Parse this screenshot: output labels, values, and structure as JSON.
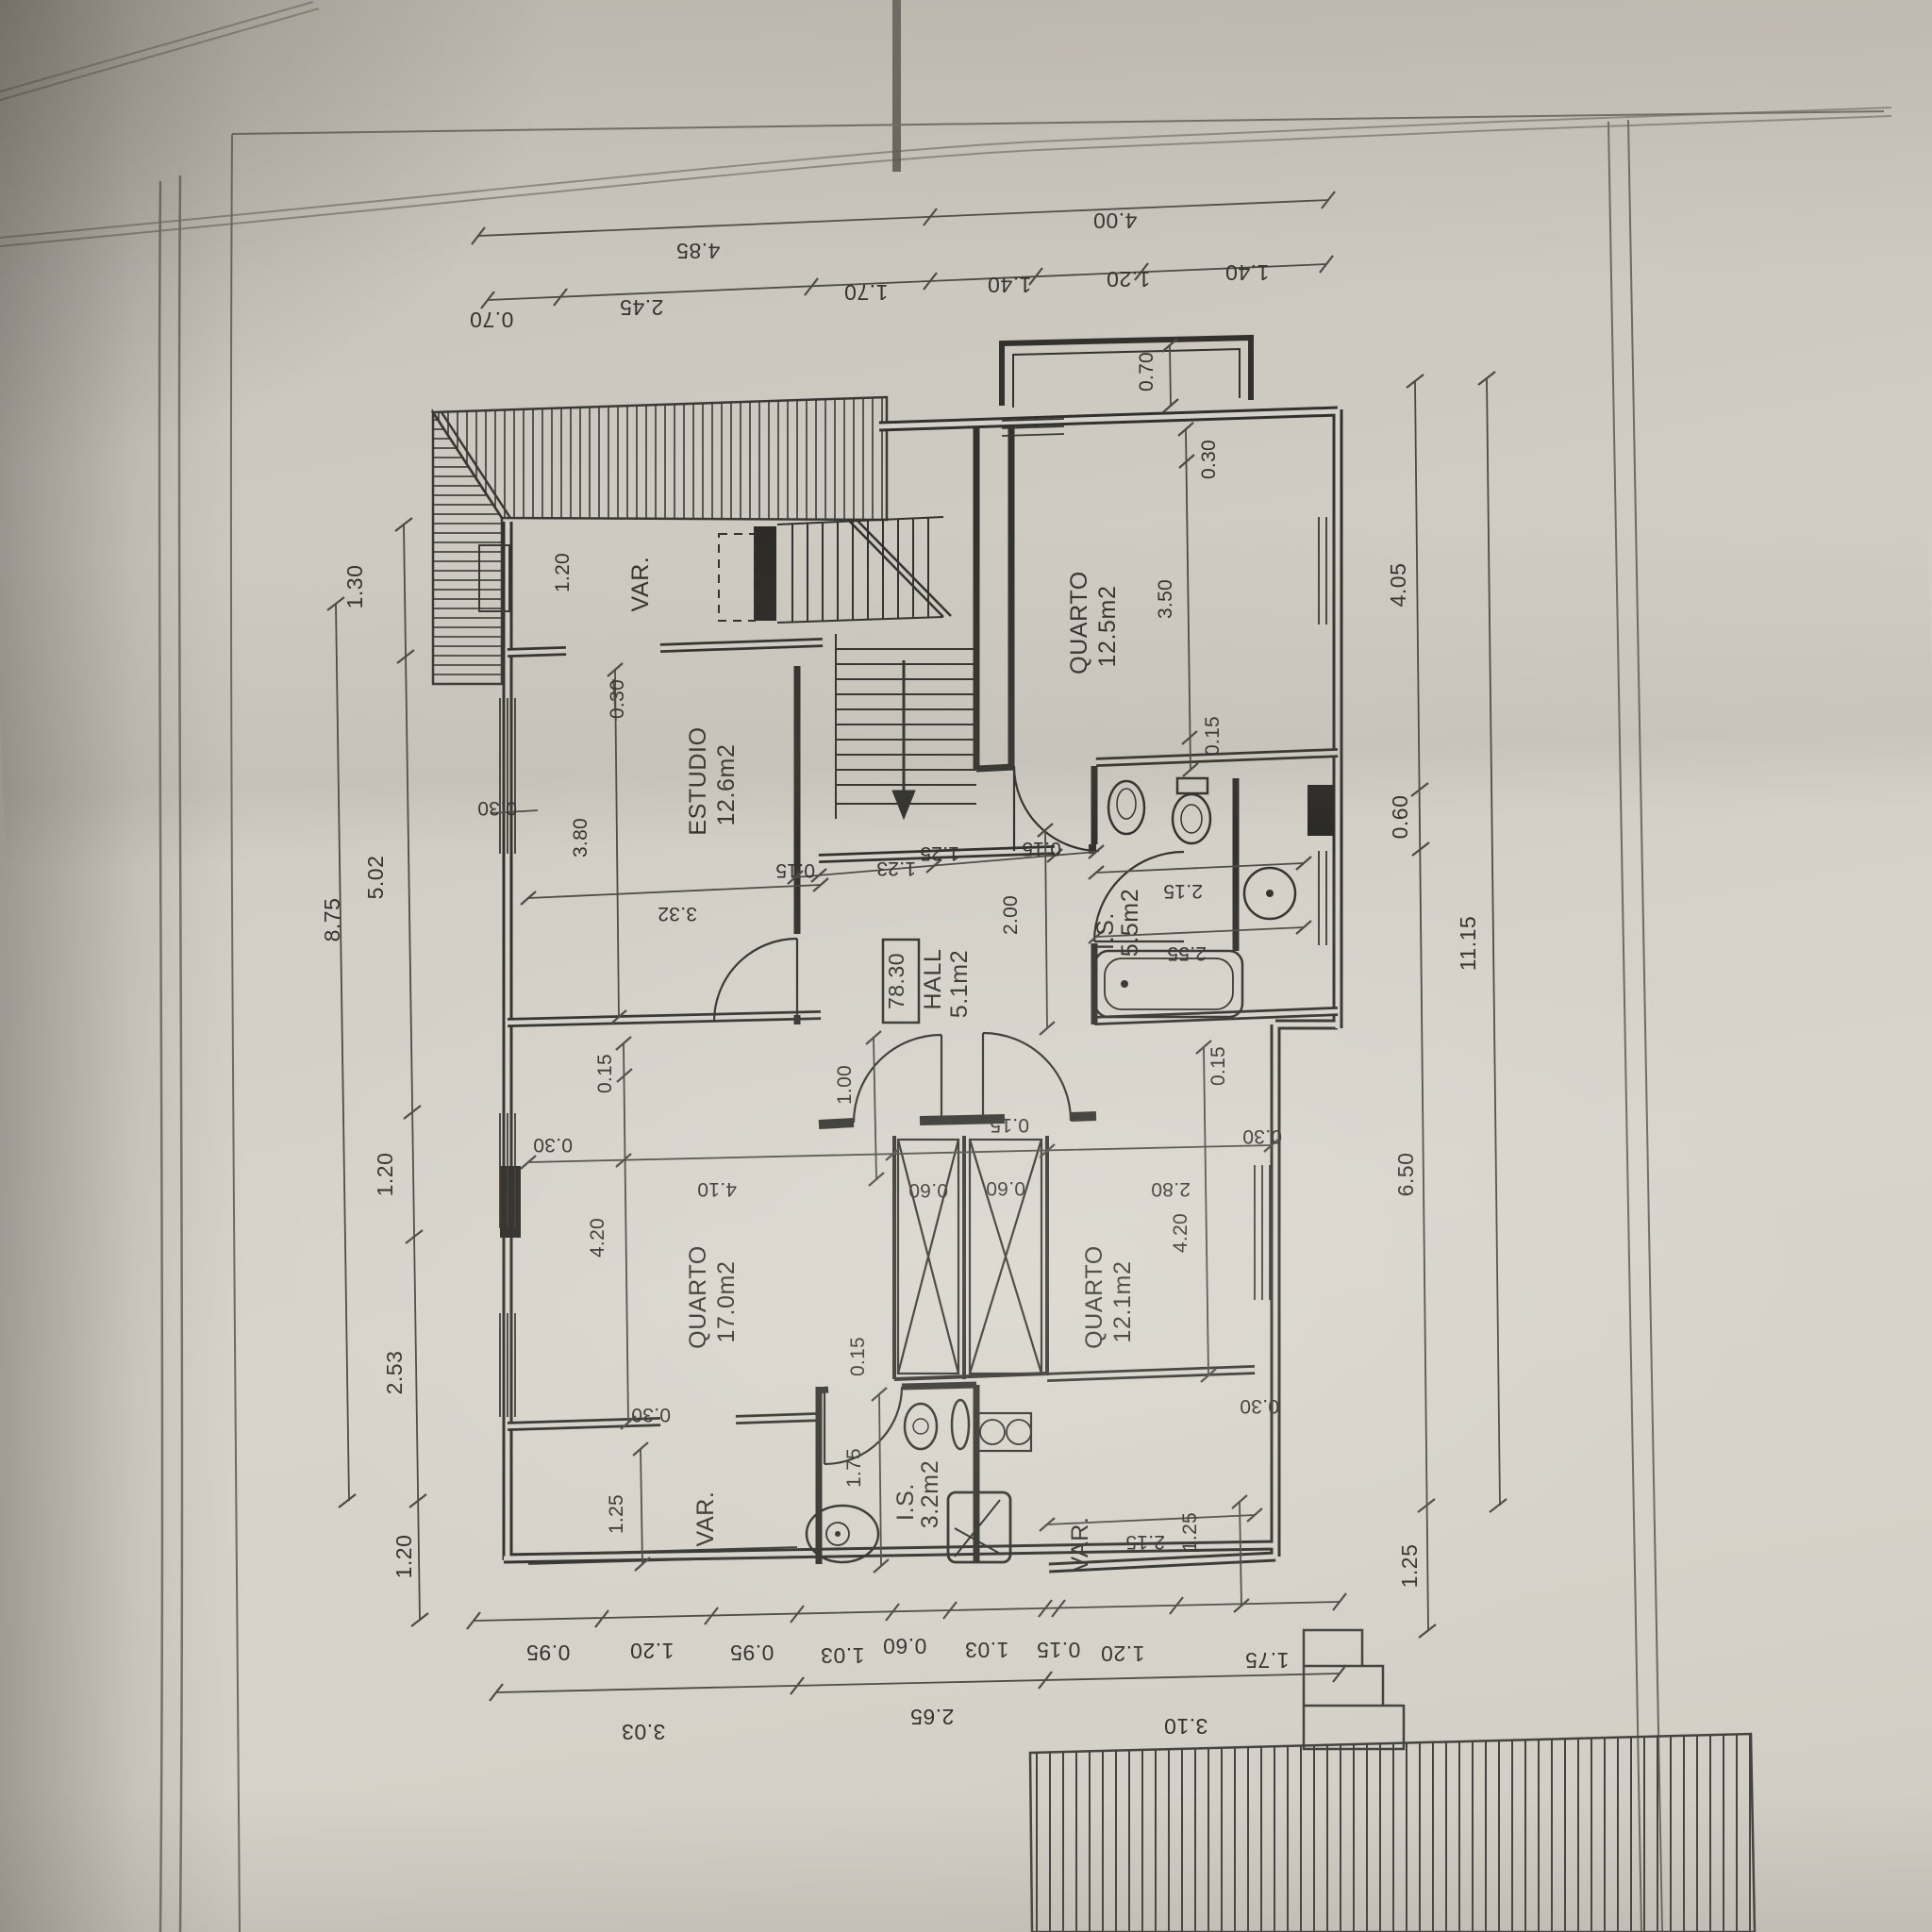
{
  "plan": {
    "level_marker": "78.30",
    "rooms": [
      {
        "name": "QUARTO",
        "area": "12.5m2"
      },
      {
        "name": "ESTUDIO",
        "area": "12.6m2"
      },
      {
        "name": "HALL",
        "area": "5.1m2"
      },
      {
        "name": "I.S.",
        "area": "5.5m2"
      },
      {
        "name": "QUARTO",
        "area": "17.0m2"
      },
      {
        "name": "QUARTO",
        "area": "12.1m2"
      },
      {
        "name": "I.S.",
        "area": "3.2m2"
      },
      {
        "name": "VAR."
      },
      {
        "name": "VAR."
      },
      {
        "name": "VAR."
      }
    ],
    "dims": {
      "top_outer": [
        "4.85",
        "4.00"
      ],
      "top_inner": [
        "0.70",
        "2.45",
        "1.70",
        "1.40",
        "1.20",
        "1.40"
      ],
      "left_outer": [
        "8.75"
      ],
      "left_inner": [
        "1.30",
        "5.02",
        "1.20",
        "2.53",
        "1.20"
      ],
      "right_outer": [
        "11.15"
      ],
      "right_inner": [
        "4.05",
        "0.60",
        "6.50",
        "1.25"
      ],
      "bottom_inner": [
        "0.95",
        "1.20",
        "0.95",
        "1.03",
        "0.60",
        "1.03",
        "0.15",
        "1.20",
        "1.75"
      ],
      "bottom_outer": [
        "3.03",
        "2.65",
        "3.10"
      ],
      "interior": [
        "1.20",
        "0.30",
        "0.30",
        "3.80",
        "3.32",
        "0.15",
        "1.23",
        "1.25",
        "0.15",
        "2.00",
        "0.70",
        "0.30",
        "3.50",
        "0.15",
        "2.15",
        "2.55",
        "0.15",
        "0.30",
        "1.00",
        "0.15",
        "0.60",
        "0.60",
        "0.30",
        "4.10",
        "0.15",
        "4.20",
        "2.80",
        "4.20",
        "0.15",
        "1.75",
        "0.30",
        "0.30",
        "1.25",
        "2.15",
        "1.25"
      ]
    }
  }
}
